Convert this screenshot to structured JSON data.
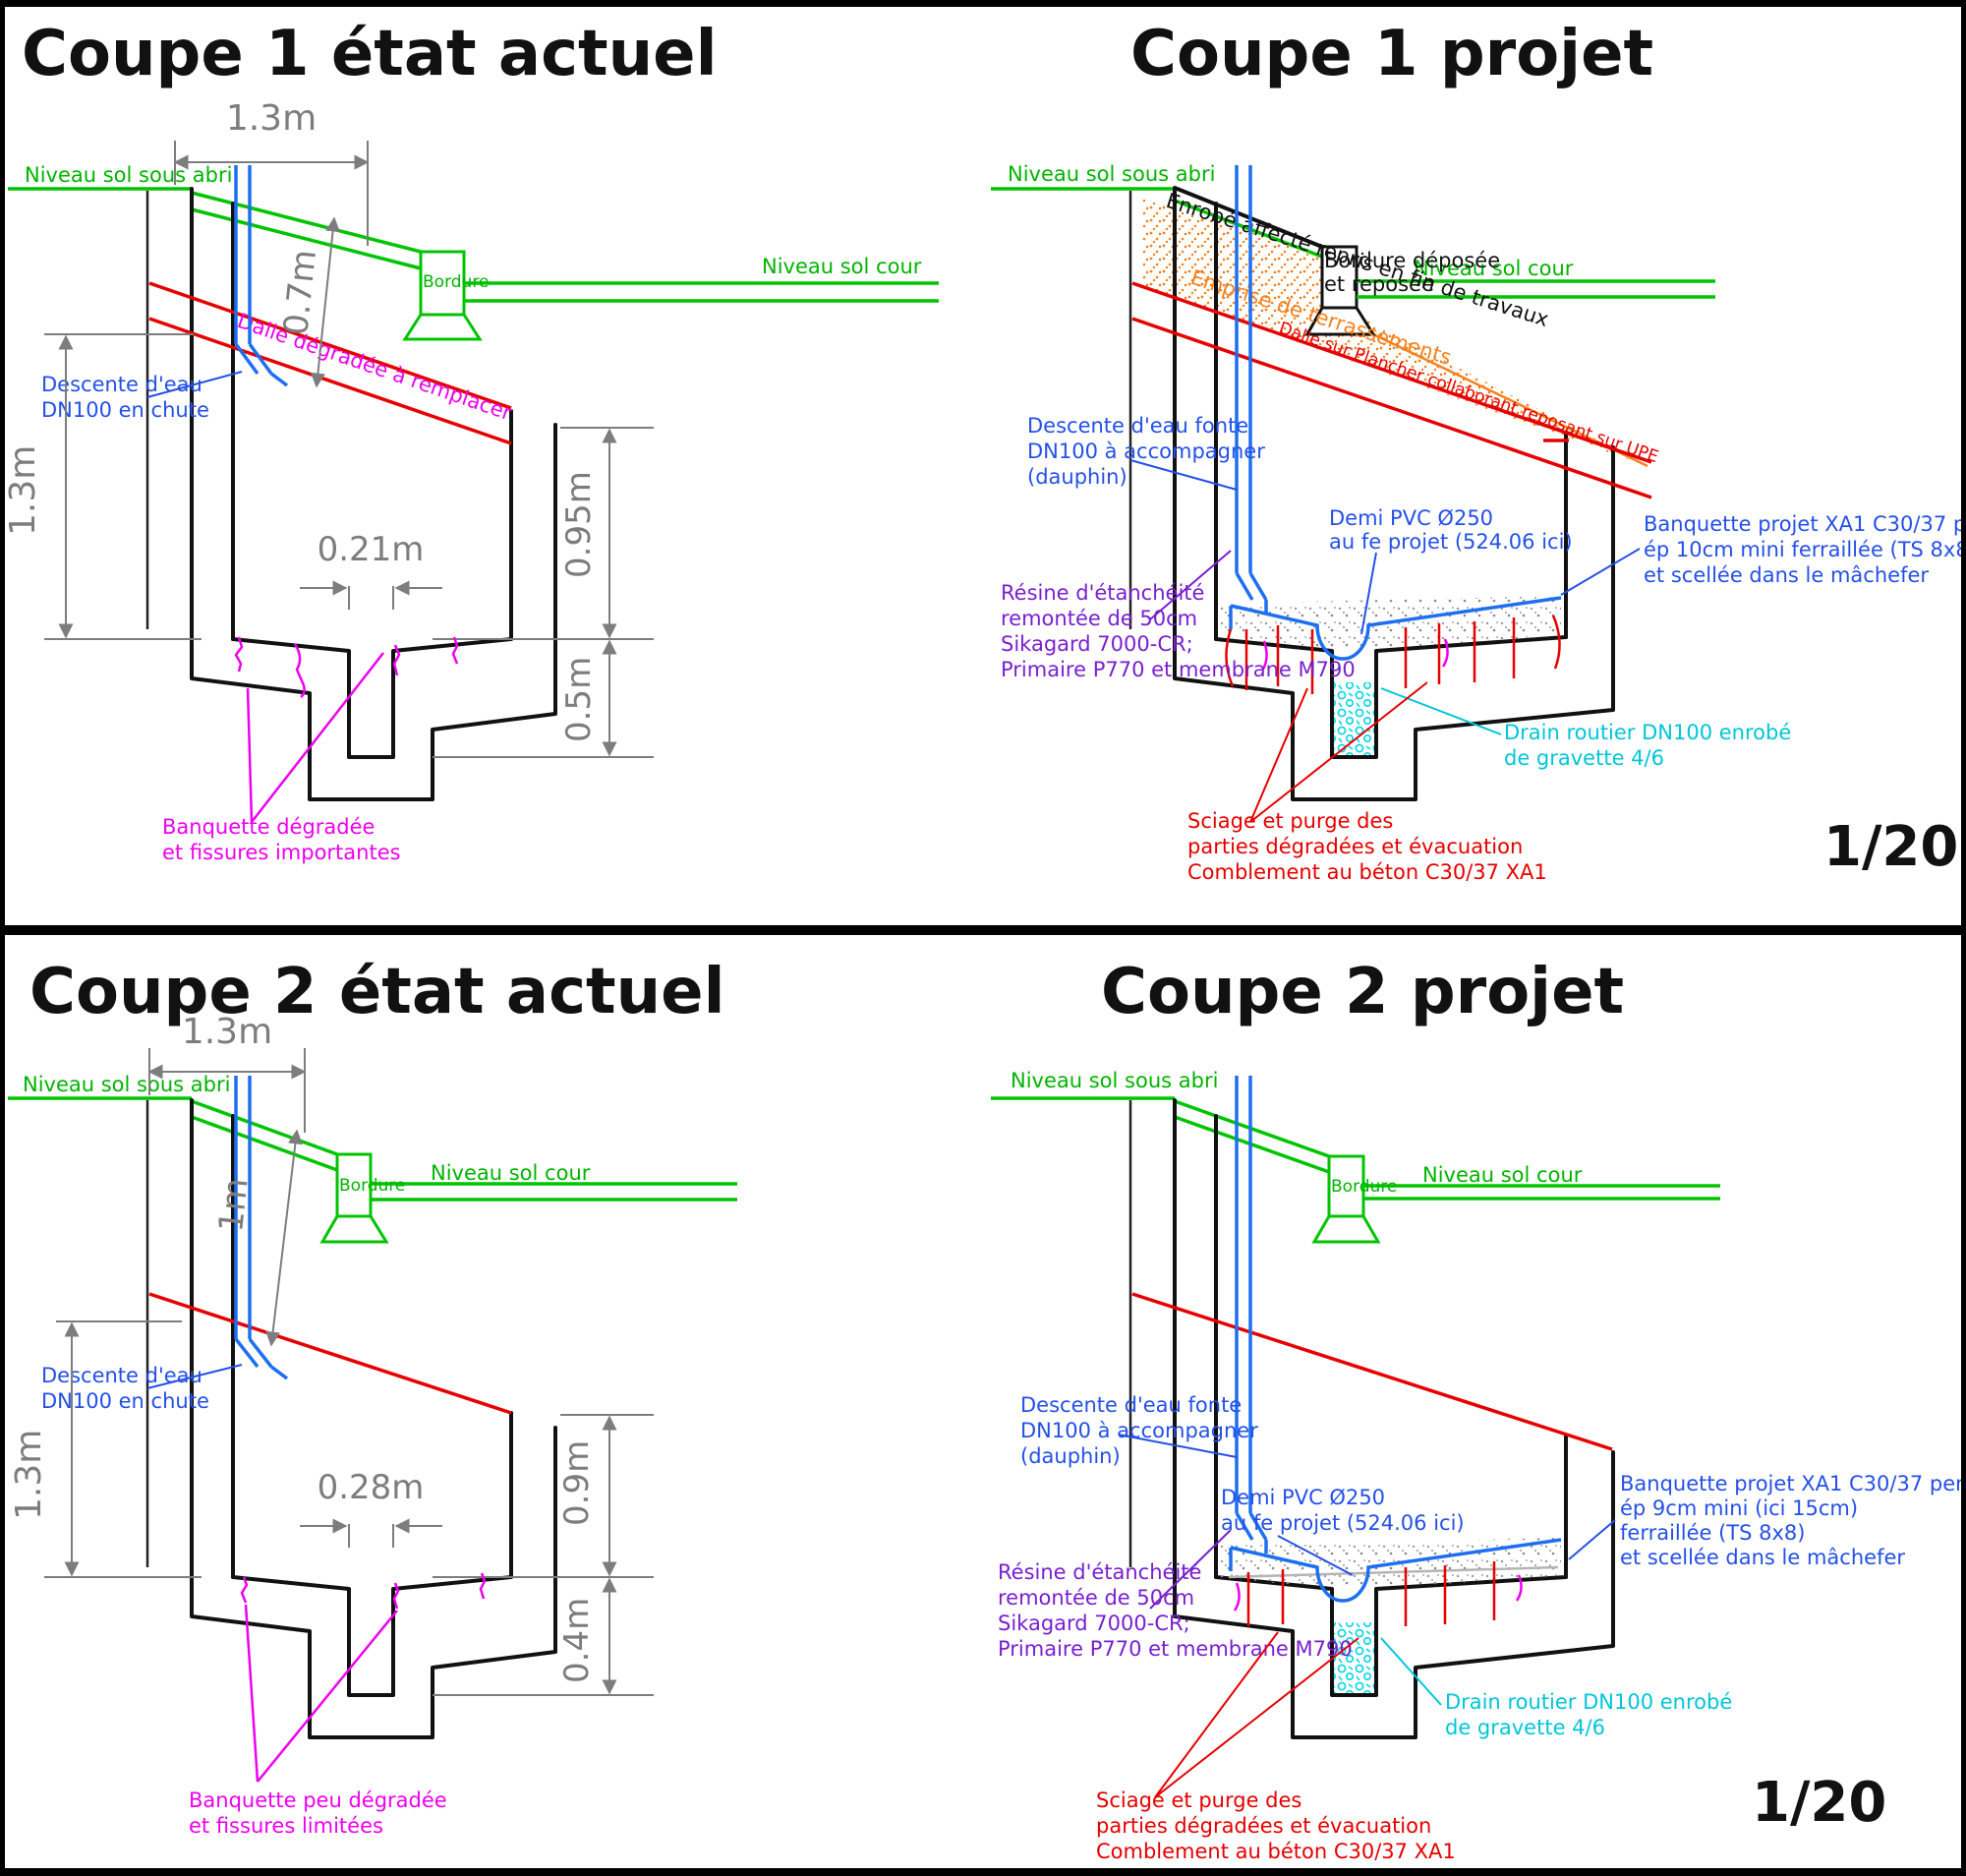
{
  "sheet": {
    "scale_label": "1/20"
  },
  "colors": {
    "level_green": "#00c400",
    "slab_red": "#e60000",
    "pipe_blue": "#1d6ff2",
    "note_blue": "#2450e8",
    "crack_magenta": "#ee00ee",
    "resin_purple": "#7a1fd0",
    "drain_cyan": "#00c6d8",
    "earthwork_orange": "#f58220",
    "dim_gray": "#7d7d7d",
    "ink_black": "#111111"
  },
  "panels": {
    "c1a": {
      "title": "Coupe 1 état actuel",
      "labels": {
        "sol_abri": "Niveau sol sous abri",
        "sol_cour": "Niveau sol cour",
        "bordure": "Bordure",
        "dim_top": "1.3m",
        "dim_roof": "0.7m",
        "dim_left": "1.3m",
        "dim_gutter": "0.21m",
        "dim_right_up": "0.95m",
        "dim_right_low": "0.5m",
        "descente": [
          "Descente d'eau",
          "DN100 en chute"
        ],
        "dalle": "Dalle dégradée à remplacer",
        "banquette": [
          "Banquette dégradée",
          "et fissures importantes"
        ]
      }
    },
    "c1p": {
      "title": "Coupe 1 projet",
      "labels": {
        "sol_abri": "Niveau sol sous abri",
        "sol_cour": "Niveau sol cour",
        "enrobe": "Enrobé affecté repris en fin de travaux",
        "emprise": "Emprise de terrassements",
        "bordure_dep": [
          "Bordure déposée",
          "et reposée"
        ],
        "dalle_plancher": "Dalle sur Plancher collaborant reposant sur UPE",
        "descente": [
          "Descente d'eau fonte",
          "DN100 à accompagner",
          "(dauphin)"
        ],
        "demi_pvc": [
          "Demi PVC Ø250",
          "au fe projet (524.06 ici)"
        ],
        "banquette": [
          "Banquette projet XA1 C30/37 pente 5%",
          "ép 10cm mini ferraillée (TS 8x8)",
          "et scellée dans le mâchefer"
        ],
        "resine": [
          "Résine d'étanchéité",
          "remontée de 50cm",
          "Sikagard 7000-CR;",
          "Primaire P770 et membrane M790"
        ],
        "drain": [
          "Drain routier DN100 enrobé",
          "de gravette 4/6"
        ],
        "sciage": [
          "Sciage et purge des",
          "parties dégradées et évacuation",
          "Comblement au béton C30/37 XA1"
        ],
        "scale": "1/20"
      }
    },
    "c2a": {
      "title": "Coupe 2 état actuel",
      "labels": {
        "sol_abri": "Niveau sol sous abri",
        "sol_cour": "Niveau sol cour",
        "bordure": "Bordure",
        "dim_top": "1.3m",
        "dim_roof": "1m",
        "dim_left": "1.3m",
        "dim_gutter": "0.28m",
        "dim_right_up": "0.9m",
        "dim_right_low": "0.4m",
        "descente": [
          "Descente d'eau",
          "DN100 en chute"
        ],
        "banquette": [
          "Banquette peu dégradée",
          "et fissures limitées"
        ]
      }
    },
    "c2p": {
      "title": "Coupe 2 projet",
      "labels": {
        "sol_abri": "Niveau sol sous abri",
        "sol_cour": "Niveau sol cour",
        "bordure": "Bordure",
        "descente": [
          "Descente d'eau fonte",
          "DN100 à accompagner",
          "(dauphin)"
        ],
        "demi_pvc": [
          "Demi PVC Ø250",
          "au fe projet (524.06 ici)"
        ],
        "banquette": [
          "Banquette projet XA1 C30/37 pente 5%",
          "ép 9cm mini (ici 15cm)",
          "ferraillée (TS 8x8)",
          "et scellée dans le mâchefer"
        ],
        "resine": [
          "Résine d'étanchéité",
          "remontée de 50cm",
          "Sikagard 7000-CR;",
          "Primaire P770 et membrane M790"
        ],
        "drain": [
          "Drain routier DN100 enrobé",
          "de gravette 4/6"
        ],
        "sciage": [
          "Sciage et purge des",
          "parties dégradées et évacuation",
          "Comblement au béton C30/37 XA1"
        ],
        "scale": "1/20"
      }
    }
  }
}
